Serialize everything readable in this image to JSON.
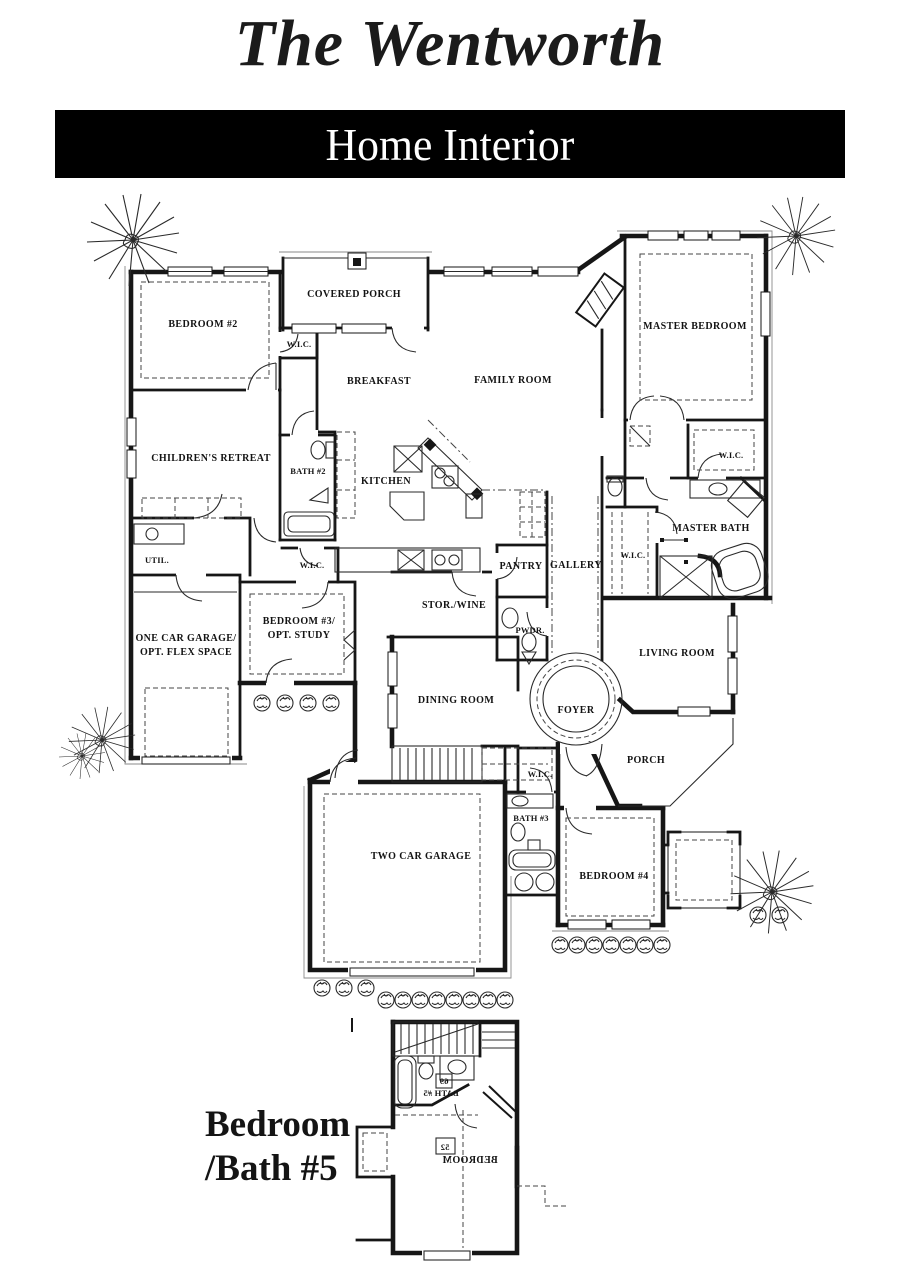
{
  "header": {
    "title": "The Wentworth",
    "banner": "Home Interior"
  },
  "rooms": {
    "covered_porch": "COVERED PORCH",
    "bedroom2": "BEDROOM #2",
    "wic_bedroom2": "W.I.C.",
    "breakfast": "BREAKFAST",
    "family_room": "FAMILY ROOM",
    "master_bedroom": "MASTER BEDROOM",
    "childrens_retreat": "CHILDREN'S RETREAT",
    "bath2": "BATH #2",
    "kitchen": "KITCHEN",
    "wic_master_upper": "W.I.C.",
    "master_bath": "MASTER BATH",
    "util": "UTIL.",
    "wic_hall": "W.I.C.",
    "pantry": "PANTRY",
    "gallery": "GALLERY",
    "wic_master": "W.I.C.",
    "one_car_garage": [
      "ONE CAR GARAGE/",
      "OPT. FLEX SPACE"
    ],
    "bedroom3": [
      "BEDROOM #3/",
      "OPT. STUDY"
    ],
    "stor_wine": "STOR./WINE",
    "pwdr": "PWDR.",
    "living_room": "LIVING ROOM",
    "dining_room": "DINING ROOM",
    "foyer": "FOYER",
    "porch": "PORCH",
    "wic_bath3": "W.I.C.",
    "bath3": "BATH #3",
    "two_car_garage": "TWO CAR GARAGE",
    "bedroom4": "BEDROOM #4"
  },
  "annotation": {
    "line1": "Bedroom",
    "line2": "/Bath #5"
  },
  "lower_plan": {
    "bath5": "BATH #5",
    "bath5_tag": "69",
    "bedroom5": "BEDROOM",
    "bedroom5_tag": "52"
  },
  "colors": {
    "ink": "#161616",
    "banner_bg": "#000000",
    "banner_text": "#ffffff",
    "paper": "#ffffff"
  }
}
